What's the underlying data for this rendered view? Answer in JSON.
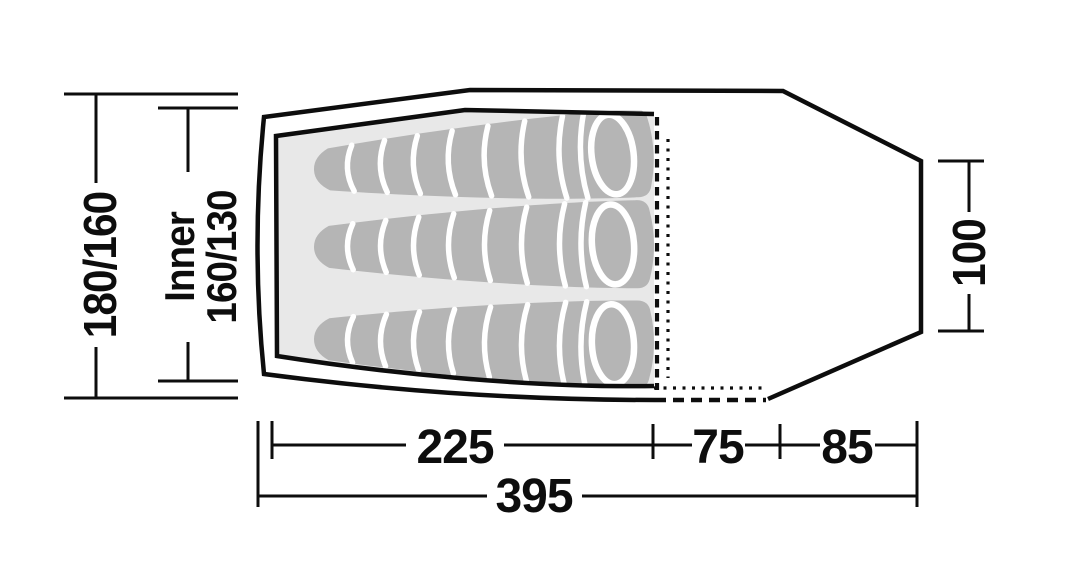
{
  "diagram": {
    "kind": "tent-floorplan-top-view",
    "sleeping_bag_count": 3,
    "labels": {
      "outer_width": "180/160",
      "inner_width_line1": "Inner",
      "inner_width_line2": "160/130",
      "rear_width": "100",
      "inner_length": "225",
      "vestibule_length": "75",
      "rear_section_length": "85",
      "total_length": "395"
    },
    "colors": {
      "outline": "#0d0d0d",
      "inner_floor": "#e8e8e8",
      "sleeping_bag": "#b5b5b5",
      "stripe": "#ffffff",
      "background": "#ffffff"
    }
  }
}
